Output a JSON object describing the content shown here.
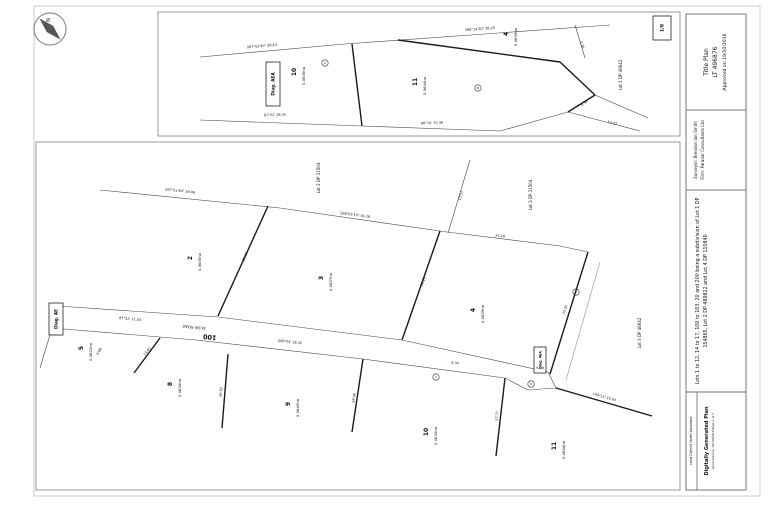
{
  "title_block": {
    "title_plan": "Title Plan",
    "plan_number": "LT 496876",
    "approved": "Approved on 19/10/2016",
    "surveyor": "Surveyor: Brendon Ian Smith",
    "firm": "Firm: Paradar Consultants Ltd",
    "description_line1": "Lots 1 to 12, 14 to 17, 100 to 103, 20 and 200 being a subdivision of Lot 1 DP",
    "description_line2": "154865, Lot 2 DP 489822 and Lot 4 DP 110840",
    "land_district": "Land District North Auckland",
    "generated": "Digitally Generated Plan",
    "generated_sub": "Generated on 19/10/2016 Page 1 of 1",
    "sheet_ref": "1/8"
  },
  "plan": {
    "colors": {
      "thick": "#1a1a1a",
      "thin": "#444444",
      "grey": "#aaaaaa",
      "frame": "#777777"
    },
    "rects": [
      {
        "x": 34,
        "y": 6,
        "w": 726,
        "h": 490,
        "c": "#cccccc",
        "n": "sheet-border"
      },
      {
        "x": 158,
        "y": 12,
        "w": 522,
        "h": 124,
        "c": "#9a9a9a",
        "n": "top-diagram-border"
      },
      {
        "x": 36,
        "y": 142,
        "w": 644,
        "h": 348,
        "c": "#9a9a9a",
        "n": "main-diagram-border"
      },
      {
        "x": 686,
        "y": 14,
        "w": 60,
        "h": 476,
        "c": "#777777",
        "n": "title-block-border"
      }
    ],
    "segments": [
      [
        200,
        57,
        345,
        44,
        "n"
      ],
      [
        345,
        44,
        610,
        25,
        "n"
      ],
      [
        352,
        44,
        362,
        126,
        "k"
      ],
      [
        200,
        120,
        362,
        126,
        "n"
      ],
      [
        362,
        126,
        500,
        131,
        "n"
      ],
      [
        500,
        131,
        568,
        112,
        "n"
      ],
      [
        398,
        40,
        560,
        62,
        "k"
      ],
      [
        560,
        62,
        595,
        95,
        "k"
      ],
      [
        595,
        95,
        568,
        112,
        "k"
      ],
      [
        595,
        95,
        648,
        118,
        "n"
      ],
      [
        575,
        25,
        585,
        58,
        "n"
      ],
      [
        568,
        112,
        640,
        131,
        "n"
      ],
      [
        100,
        190,
        280,
        208,
        "n"
      ],
      [
        280,
        208,
        447,
        232,
        "n"
      ],
      [
        447,
        232,
        560,
        246,
        "n"
      ],
      [
        560,
        246,
        588,
        252,
        "n"
      ],
      [
        470,
        160,
        448,
        233,
        "n"
      ],
      [
        268,
        206,
        218,
        316,
        "k"
      ],
      [
        440,
        231,
        402,
        340,
        "k"
      ],
      [
        588,
        252,
        550,
        374,
        "k"
      ],
      [
        600,
        262,
        566,
        380,
        "g"
      ],
      [
        58,
        306,
        218,
        317,
        "n"
      ],
      [
        218,
        317,
        402,
        340,
        "n"
      ],
      [
        402,
        340,
        548,
        372,
        "n"
      ],
      [
        52,
        328,
        196,
        340,
        "n"
      ],
      [
        196,
        340,
        363,
        359,
        "n"
      ],
      [
        363,
        359,
        505,
        378,
        "n"
      ],
      [
        58,
        306,
        52,
        328,
        "n"
      ],
      [
        52,
        328,
        40,
        368,
        "n"
      ],
      [
        160,
        338,
        134,
        373,
        "k"
      ],
      [
        228,
        354,
        222,
        428,
        "k"
      ],
      [
        363,
        359,
        352,
        432,
        "k"
      ],
      [
        505,
        378,
        496,
        456,
        "k"
      ],
      [
        505,
        378,
        528,
        390,
        "n"
      ],
      [
        528,
        390,
        556,
        388,
        "n"
      ],
      [
        556,
        388,
        548,
        372,
        "n"
      ],
      [
        556,
        388,
        652,
        416,
        "k"
      ],
      [
        686,
        110,
        746,
        110,
        "s"
      ],
      [
        686,
        190,
        746,
        190,
        "s"
      ],
      [
        686,
        392,
        746,
        392,
        "s"
      ],
      [
        697,
        392,
        697,
        490,
        "s"
      ]
    ],
    "boxes": [
      {
        "t": "Diag. AEA",
        "x": 266,
        "y": 62,
        "w": 14,
        "h": 44,
        "s": 4.2
      },
      {
        "t": "Diag. AE",
        "x": 49,
        "y": 303,
        "w": 14,
        "h": 32,
        "s": 4.2
      },
      {
        "t": "Diag. AEA",
        "x": 534,
        "y": 347,
        "w": 12,
        "h": 26,
        "s": 3.2
      },
      {
        "t": "1/8",
        "x": 653,
        "y": 16,
        "w": 18,
        "h": 24,
        "s": 4.5
      }
    ],
    "labels": [
      {
        "t": "10",
        "x": 296,
        "y": 72,
        "s": 6,
        "w": "bold",
        "n": "lot-number"
      },
      {
        "t": "0.0600ha",
        "x": 305,
        "y": 76,
        "s": 3.8,
        "n": "lot-area"
      },
      {
        "t": "11",
        "x": 417,
        "y": 82,
        "s": 6,
        "w": "bold",
        "n": "lot-number"
      },
      {
        "t": "0.0644ha",
        "x": 426,
        "y": 86,
        "s": 3.8,
        "n": "lot-area"
      },
      {
        "t": "4",
        "x": 508,
        "y": 34,
        "s": 6,
        "w": "bold",
        "n": "lot-number"
      },
      {
        "t": "0.0609ha",
        "x": 517,
        "y": 37,
        "s": 3.8,
        "n": "lot-area"
      },
      {
        "t": "Lot 1 DP 46642",
        "x": 622,
        "y": 75,
        "s": 4,
        "n": "adjoining-lot-label"
      },
      {
        "t": "2",
        "x": 192,
        "y": 258,
        "s": 6,
        "w": "bold",
        "n": "lot-number"
      },
      {
        "t": "0.0605ha",
        "x": 201,
        "y": 262,
        "s": 3.8,
        "n": "lot-area"
      },
      {
        "t": "3",
        "x": 323,
        "y": 278,
        "s": 6,
        "w": "bold",
        "n": "lot-number"
      },
      {
        "t": "0.0607ha",
        "x": 332,
        "y": 282,
        "s": 3.8,
        "n": "lot-area"
      },
      {
        "t": "4",
        "x": 475,
        "y": 310,
        "s": 6,
        "w": "bold",
        "n": "lot-number"
      },
      {
        "t": "0.0609ha",
        "x": 484,
        "y": 314,
        "s": 3.8,
        "n": "lot-area"
      },
      {
        "t": "5",
        "x": 83,
        "y": 348,
        "s": 6,
        "w": "bold",
        "n": "lot-number"
      },
      {
        "t": "0.0601ha",
        "x": 92,
        "y": 352,
        "s": 3.8,
        "n": "lot-area"
      },
      {
        "t": "8",
        "x": 172,
        "y": 384,
        "s": 6,
        "w": "bold",
        "n": "lot-number"
      },
      {
        "t": "0.0634ha",
        "x": 181,
        "y": 388,
        "s": 3.8,
        "n": "lot-area"
      },
      {
        "t": "9",
        "x": 290,
        "y": 404,
        "s": 6,
        "w": "bold",
        "n": "lot-number"
      },
      {
        "t": "0.0640ha",
        "x": 299,
        "y": 408,
        "s": 3.8,
        "n": "lot-area"
      },
      {
        "t": "10",
        "x": 428,
        "y": 432,
        "s": 6,
        "w": "bold",
        "n": "lot-number"
      },
      {
        "t": "0.0630ha",
        "x": 437,
        "y": 436,
        "s": 3.8,
        "n": "lot-area"
      },
      {
        "t": "11",
        "x": 556,
        "y": 446,
        "s": 6,
        "w": "bold",
        "n": "lot-number"
      },
      {
        "t": "0.0644ha",
        "x": 565,
        "y": 450,
        "s": 3.8,
        "n": "lot-area"
      },
      {
        "t": "Lot 2 DP 31504",
        "x": 320,
        "y": 178,
        "s": 4,
        "n": "adjoining-lot-label"
      },
      {
        "t": "Lot 3 DP 31504",
        "x": 532,
        "y": 195,
        "s": 4,
        "n": "adjoining-lot-label"
      },
      {
        "t": "Lot 3 DP 46642",
        "x": 641,
        "y": 333,
        "s": 4,
        "n": "adjoining-lot-label"
      },
      {
        "t": "ELSIE ROAD",
        "x": 194,
        "y": 326,
        "r": 186,
        "s": 3.8,
        "i": 1,
        "n": "road-name"
      },
      {
        "t": "100",
        "x": 210,
        "y": 335,
        "r": 186,
        "s": 6.5,
        "w": "bold",
        "n": "road-lot-number"
      },
      {
        "t": "267°52'40\" 28.43",
        "x": 262,
        "y": 47,
        "r": -5,
        "s": 3.4,
        "c": "#333",
        "n": "bearing-label"
      },
      {
        "t": "268°14'20\" 36.25",
        "x": 480,
        "y": 30,
        "r": -4,
        "s": 3.4,
        "c": "#333",
        "n": "bearing-label"
      },
      {
        "t": "87°52' 26.35",
        "x": 275,
        "y": 116,
        "r": -2,
        "s": 3.4,
        "c": "#333",
        "n": "bearing-label"
      },
      {
        "t": "88°14' 33.36",
        "x": 432,
        "y": 124,
        "r": -2,
        "s": 3.4,
        "c": "#333",
        "n": "bearing-label"
      },
      {
        "t": "3.26",
        "x": 581,
        "y": 45,
        "r": 72,
        "s": 3.4,
        "c": "#333",
        "n": "bearing-label"
      },
      {
        "t": "4.39",
        "x": 585,
        "y": 104,
        "r": -38,
        "s": 3.4,
        "c": "#333",
        "n": "bearing-label"
      },
      {
        "t": "13.57",
        "x": 612,
        "y": 124,
        "r": 15,
        "s": 3.4,
        "c": "#333",
        "n": "bearing-label"
      },
      {
        "t": "267°52'40\" 26.06",
        "x": 180,
        "y": 192,
        "r": 6,
        "s": 3.4,
        "c": "#333",
        "n": "bearing-label"
      },
      {
        "t": "268°05'10\" 34.26",
        "x": 355,
        "y": 216,
        "r": 7,
        "s": 3.4,
        "c": "#333",
        "n": "bearing-label"
      },
      {
        "t": "25.29",
        "x": 500,
        "y": 237,
        "r": 6,
        "s": 3.4,
        "c": "#333",
        "n": "bearing-label"
      },
      {
        "t": "13.57",
        "x": 462,
        "y": 196,
        "r": -72,
        "s": 3.4,
        "c": "#333",
        "n": "bearing-label"
      },
      {
        "t": "26.35",
        "x": 246,
        "y": 257,
        "r": -66,
        "s": 3.4,
        "c": "#333",
        "n": "bearing-label"
      },
      {
        "t": "26.10",
        "x": 424,
        "y": 282,
        "r": -69,
        "s": 3.4,
        "c": "#333",
        "n": "bearing-label"
      },
      {
        "t": "25.35",
        "x": 566,
        "y": 310,
        "r": -71,
        "s": 3.4,
        "c": "#333",
        "n": "bearing-label"
      },
      {
        "t": "87°52' 21.03",
        "x": 130,
        "y": 320,
        "r": 5,
        "s": 3.4,
        "c": "#333",
        "n": "bearing-label"
      },
      {
        "t": "268°05' 26.35",
        "x": 290,
        "y": 343,
        "r": 6,
        "s": 3.4,
        "c": "#333",
        "n": "bearing-label"
      },
      {
        "t": "8.34",
        "x": 455,
        "y": 364,
        "r": 6,
        "s": 3.4,
        "c": "#333",
        "n": "bearing-label"
      },
      {
        "t": "13.01",
        "x": 148,
        "y": 352,
        "r": -53,
        "s": 3.4,
        "c": "#333",
        "n": "bearing-label"
      },
      {
        "t": "40.93",
        "x": 222,
        "y": 392,
        "r": -86,
        "s": 3.4,
        "c": "#333",
        "n": "bearing-label"
      },
      {
        "t": "38.06",
        "x": 355,
        "y": 398,
        "r": -83,
        "s": 3.4,
        "c": "#333",
        "n": "bearing-label"
      },
      {
        "t": "37.77",
        "x": 498,
        "y": 416,
        "r": -84,
        "s": 3.4,
        "c": "#333",
        "n": "bearing-label"
      },
      {
        "t": "140°12' 23.03",
        "x": 604,
        "y": 398,
        "r": 16,
        "s": 3.4,
        "c": "#333",
        "n": "bearing-label"
      },
      {
        "t": "4.08",
        "x": 100,
        "y": 352,
        "r": -60,
        "s": 3.4,
        "c": "#333",
        "n": "bearing-label"
      },
      {
        "t": "6.39",
        "x": 540,
        "y": 369,
        "r": 4,
        "s": 3.4,
        "c": "#333",
        "n": "bearing-label"
      }
    ],
    "circles": [
      {
        "x": 325,
        "y": 63,
        "t": "A"
      },
      {
        "x": 478,
        "y": 88,
        "t": "B"
      },
      {
        "x": 436,
        "y": 377,
        "t": "C"
      },
      {
        "x": 531,
        "y": 384,
        "t": "D"
      },
      {
        "x": 576,
        "y": 292,
        "t": "E"
      }
    ]
  }
}
